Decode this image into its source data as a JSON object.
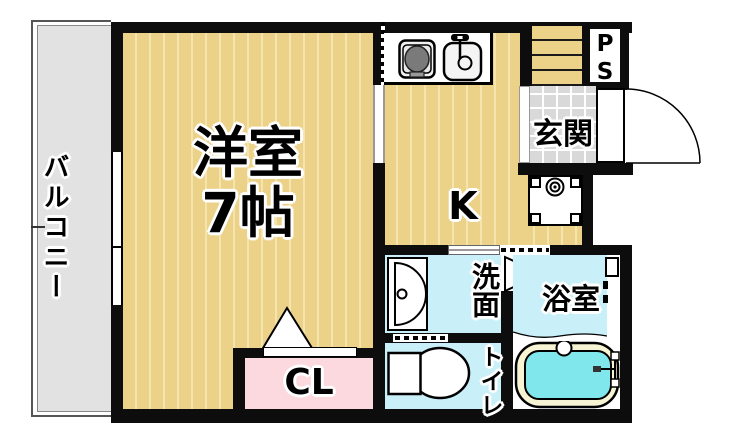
{
  "plan": {
    "rooms": {
      "balcony": {
        "label": "バルコニー"
      },
      "western_room": {
        "label": "洋室",
        "size": "7帖"
      },
      "kitchen": {
        "label": "K"
      },
      "closet": {
        "label": "CL"
      },
      "entrance": {
        "label": "玄関"
      },
      "pipe_space": {
        "label": "PS"
      },
      "washroom": {
        "label": "洗面"
      },
      "bathroom": {
        "label": "浴室"
      },
      "toilet": {
        "label": "トイレ"
      }
    },
    "colors": {
      "wall": "#0d0d0d",
      "wood_floor": "#ecd189",
      "wood_stripe": "#f4e4ae",
      "balcony_gray": "#e2e2e2",
      "entrance_tile": "#d9d9d9",
      "wet_room_cyan": "#c9f0f8",
      "closet_pink": "#fcd9de",
      "bath_water": "#80e8ec",
      "tub_rim": "#f7f4d3",
      "burner_gray": "#7a7a7a"
    },
    "icons": [
      "stove-icon",
      "sink-icon",
      "washer-pan-icon",
      "faucet-icon",
      "washbasin-icon",
      "toilet-icon",
      "bathtub-icon",
      "entrance-door-arc",
      "bath-door-triangle",
      "closet-door-triangle",
      "window",
      "sliding-door"
    ]
  }
}
